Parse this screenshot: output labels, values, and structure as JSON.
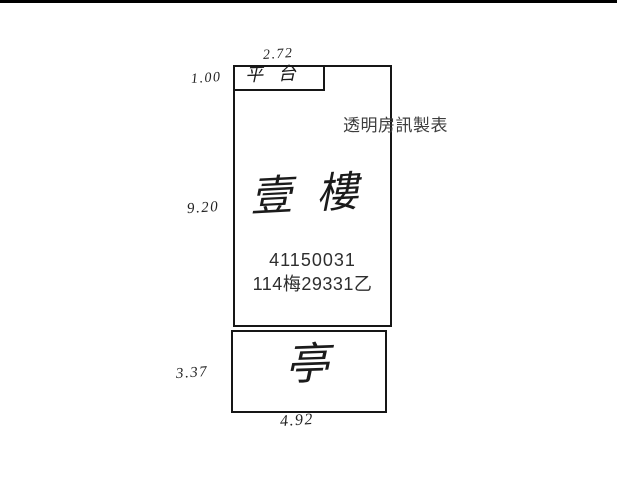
{
  "credit": {
    "maker": "透明房訊製表"
  },
  "plan": {
    "first_floor": {
      "label": "壹樓",
      "building_no": "41150031",
      "case_no": "114梅29331乙"
    },
    "platform": {
      "label": "平台"
    },
    "pavilion": {
      "label": "亭"
    },
    "dimensions": {
      "platform_width": "2.72",
      "platform_height": "1.00",
      "first_floor_height": "9.20",
      "pavilion_height": "3.37",
      "pavilion_width": "4.92"
    }
  },
  "colors": {
    "line": "#161616",
    "background": "#ffffff",
    "scan_bar": "#000000"
  }
}
